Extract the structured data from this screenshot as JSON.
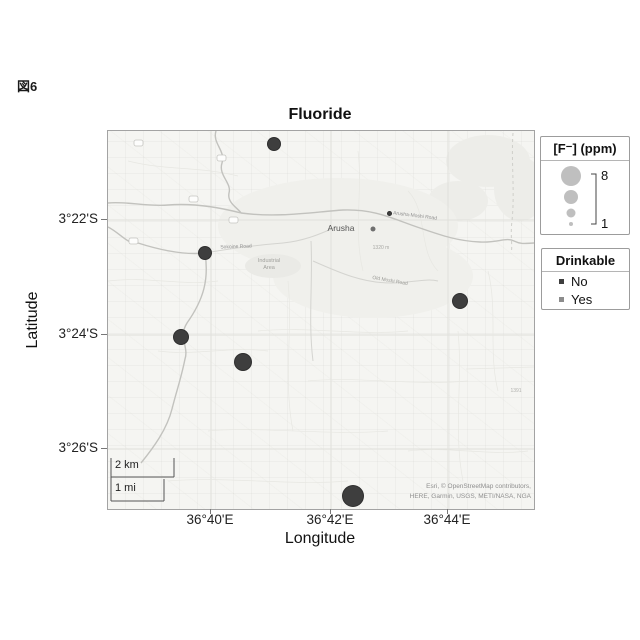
{
  "figure_label": "図6",
  "title": "Fluoride",
  "axes": {
    "xlabel": "Longitude",
    "ylabel": "Latitude",
    "x_ticks": [
      {
        "label": "36°40'E",
        "x": 210
      },
      {
        "label": "36°42'E",
        "x": 330
      },
      {
        "label": "36°44'E",
        "x": 447
      }
    ],
    "y_ticks": [
      {
        "label": "3°22'S",
        "y": 219
      },
      {
        "label": "3°24'S",
        "y": 334
      },
      {
        "label": "3°26'S",
        "y": 448
      }
    ]
  },
  "size_legend": {
    "title": "[F⁻] (ppm)",
    "max_label": "8",
    "min_label": "1"
  },
  "color_legend": {
    "title": "Drinkable",
    "items": [
      {
        "label": "No",
        "color": "#3e3e3e"
      },
      {
        "label": "Yes",
        "color": "#8c8c8c"
      }
    ]
  },
  "scalebar": {
    "km_label": "2 km",
    "mi_label": "1 mi"
  },
  "attribution": {
    "line1": "Esri, © OpenStreetMap contributors,",
    "line2": "HERE, Garmin, USGS, METI/NASA, NGA"
  },
  "basemap_labels": [
    {
      "text": "Arusha",
      "x": 233,
      "y": 97,
      "size": 8.5,
      "color": "#555555",
      "rot": 0
    },
    {
      "text": "Arusha-Moshi Road",
      "x": 307,
      "y": 85,
      "size": 5,
      "color": "#8f8f8f",
      "rot": 7
    },
    {
      "text": "Sokoine Road",
      "x": 128,
      "y": 116,
      "size": 5,
      "color": "#8f8f8f",
      "rot": -2
    },
    {
      "text": "Industrial",
      "x": 161,
      "y": 130,
      "size": 5.5,
      "color": "#a0a09c",
      "rot": 0
    },
    {
      "text": "Area",
      "x": 161,
      "y": 137,
      "size": 5.5,
      "color": "#a0a09c",
      "rot": 0
    },
    {
      "text": "1320 m",
      "x": 273,
      "y": 117,
      "size": 5,
      "color": "#a8a8a4",
      "rot": 0
    },
    {
      "text": "Old Moshi Road",
      "x": 282,
      "y": 150,
      "size": 5,
      "color": "#9a9a96",
      "rot": 10
    },
    {
      "text": "1391",
      "x": 408,
      "y": 260,
      "size": 5,
      "color": "#b2b2ae",
      "rot": 0
    }
  ],
  "chart_data": {
    "type": "scatter",
    "subtype": "geobubble-map",
    "title": "Fluoride",
    "xlabel": "Longitude",
    "ylabel": "Latitude",
    "lon_range_deg_E": [
      36.638,
      36.757
    ],
    "lat_range_deg": [
      -3.45,
      -3.341
    ],
    "bubble_size_range_ppm": [
      1,
      8
    ],
    "size_legend_reference": [
      {
        "ppm": 8,
        "r": 10
      },
      {
        "ppm": 1,
        "r": 2
      }
    ],
    "points": [
      {
        "lon": 36.684,
        "lat": -3.345,
        "ppm": 4,
        "drinkable": "No",
        "px": 166,
        "py": 13,
        "r": 7
      },
      {
        "lon": 36.665,
        "lat": -3.376,
        "ppm": 4,
        "drinkable": "No",
        "px": 97,
        "py": 122,
        "r": 7
      },
      {
        "lon": 36.658,
        "lat": -3.401,
        "ppm": 5,
        "drinkable": "No",
        "px": 73,
        "py": 206,
        "r": 8
      },
      {
        "lon": 36.676,
        "lat": -3.408,
        "ppm": 6,
        "drinkable": "No",
        "px": 135,
        "py": 231,
        "r": 9
      },
      {
        "lon": 36.737,
        "lat": -3.39,
        "ppm": 5,
        "drinkable": "No",
        "px": 352,
        "py": 170,
        "r": 8
      },
      {
        "lon": 36.707,
        "lat": -3.447,
        "ppm": 8,
        "drinkable": "No",
        "px": 245,
        "py": 365,
        "r": 11
      },
      {
        "lon": 36.717,
        "lat": -3.365,
        "ppm": 1,
        "drinkable": "No",
        "px": 281,
        "py": 82,
        "r": 2.5
      }
    ]
  }
}
